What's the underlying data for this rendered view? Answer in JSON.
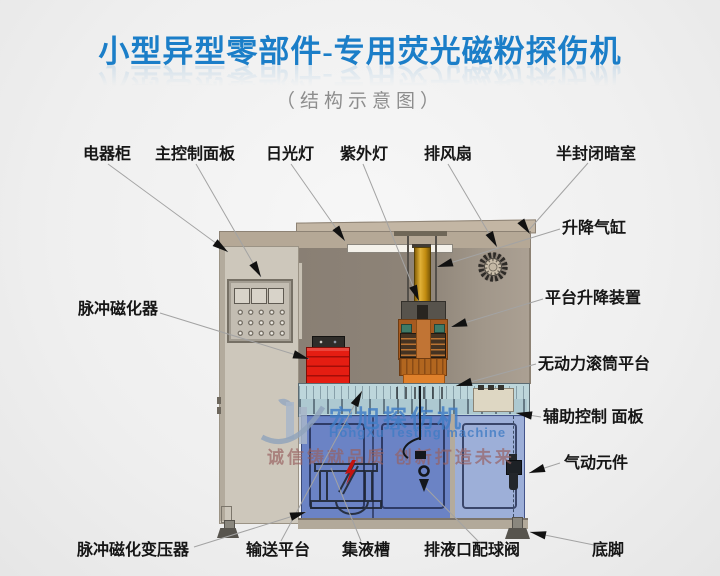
{
  "title": {
    "main": "小型异型零部件-专用荧光磁粉探伤机",
    "subtitle": "（结构示意图）",
    "title_color": "#1b7ec8"
  },
  "watermark": {
    "logo": "hongxu-h-swoosh-logo",
    "brand_cn": "宏旭探伤机",
    "brand_en": "HongXu Testing machine",
    "slogan": "诚信铸就品质  创新打造未来"
  },
  "callouts": {
    "top": [
      {
        "text": "电器柜"
      },
      {
        "text": "主控制面板"
      },
      {
        "text": "日光灯"
      },
      {
        "text": "紫外灯"
      },
      {
        "text": "排风扇"
      },
      {
        "text": "半封闭暗室"
      }
    ],
    "right": [
      {
        "text": "升降气缸"
      },
      {
        "text": "平台升降装置"
      },
      {
        "text": "无动力滚筒平台"
      },
      {
        "text": "辅助控制 面板"
      },
      {
        "text": "气动元件"
      }
    ],
    "left": [
      {
        "text": "脉冲磁化器"
      }
    ],
    "bottom": [
      {
        "text": "脉冲磁化变压器"
      },
      {
        "text": "输送平台"
      },
      {
        "text": "集液槽"
      },
      {
        "text": "排液口配球阀"
      },
      {
        "text": "底脚"
      }
    ]
  },
  "colors": {
    "title_blue": "#1b7ec8",
    "pulse_magnetizer_red": "#e51d12",
    "lift_cylinder_yellow": "#c28c10",
    "magnetizing_head_orange": "#a65a20",
    "door_blue": "#5f79c1",
    "door_light_blue": "#98abd6",
    "cabinet_tan": "#cdc7bb",
    "watermark_blue": "#407cc4"
  }
}
